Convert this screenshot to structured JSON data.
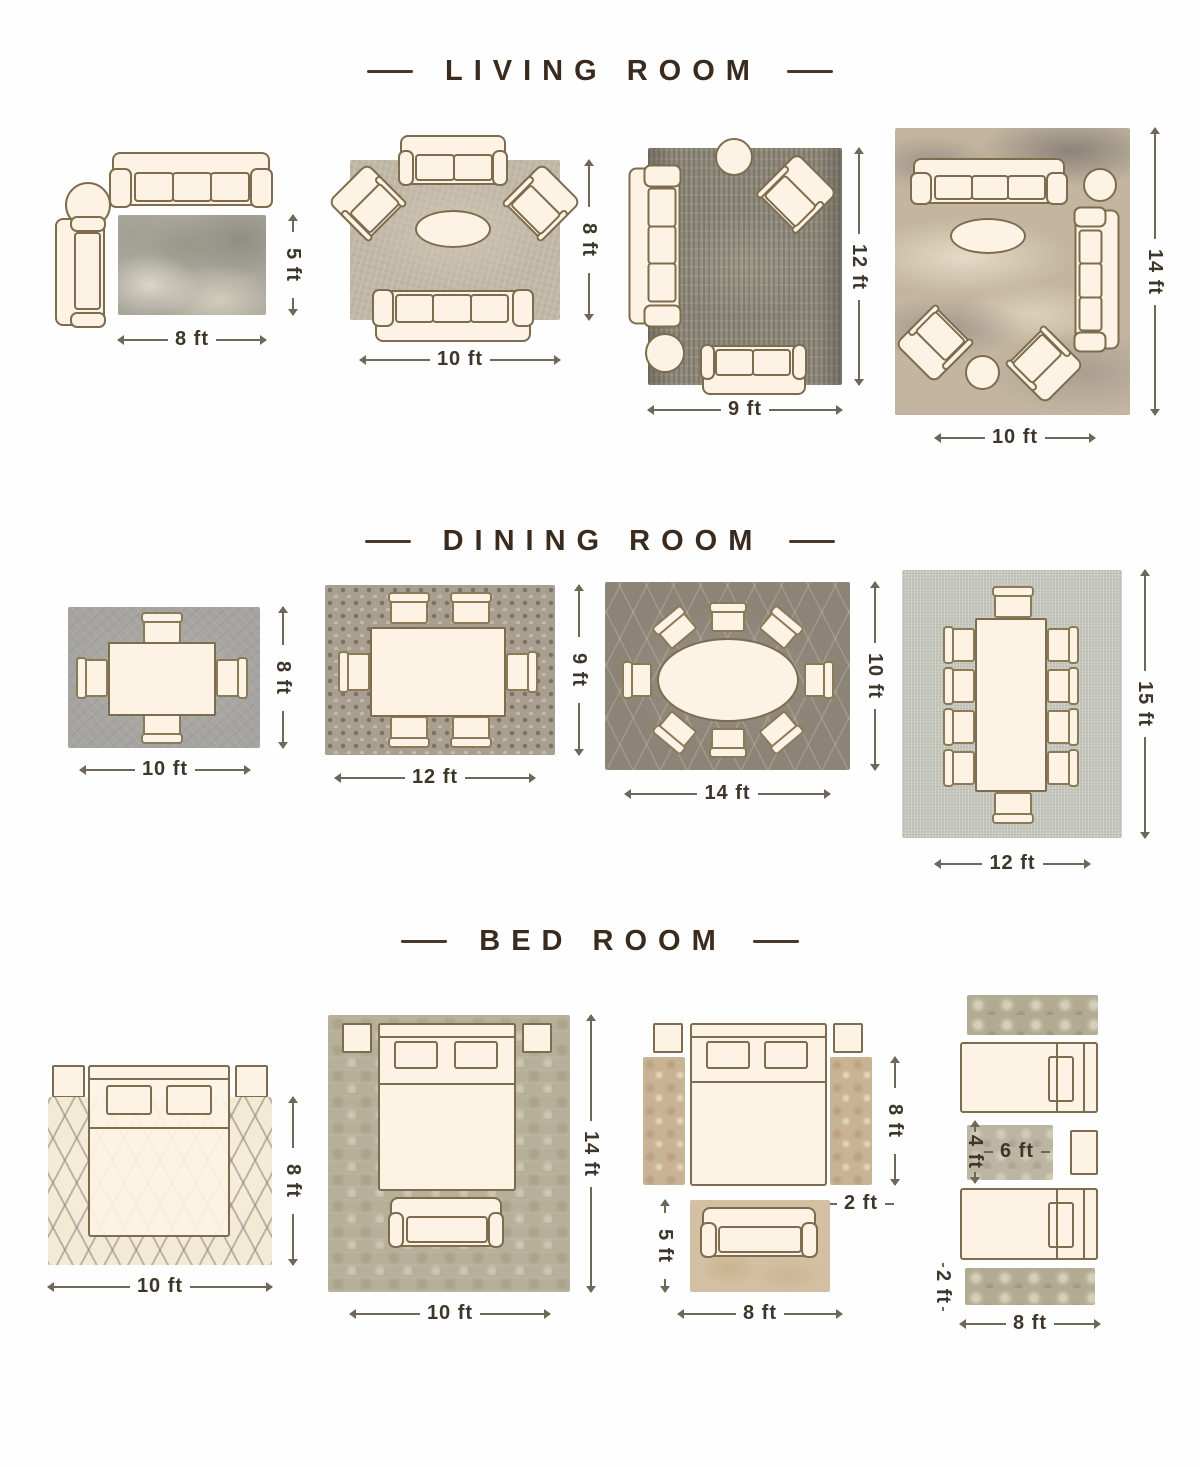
{
  "page": {
    "background": "#ffffff"
  },
  "palette": {
    "title_color": "#3b2b1e",
    "dimension_text_color": "#3e362b",
    "dimension_line_color": "#6e675a",
    "furniture_fill": "#fcf3e4",
    "furniture_outline": "#7e6c4e",
    "rug_living_1": "#a8a59a",
    "rug_living_2": "#c0b7a6",
    "rug_living_3": "#8f8a7b",
    "rug_living_4": "#c3b5a0",
    "rug_dining_1": "#a5a4a0",
    "rug_dining_2": "#a89f90",
    "rug_dining_3": "#8b8477",
    "rug_dining_4": "#c4c6bc",
    "rug_bed_1": "#f3ead5",
    "rug_bed_2": "#b6b09a",
    "rug_bed_3_runner": "#c8b394",
    "rug_bed_3_foot": "#d3c0a2",
    "rug_bed_4_runner": "#b2aa91",
    "rug_bed_4_mid": "#bcb5a2"
  },
  "sections": [
    {
      "id": "living-room",
      "title": "LIVING ROOM",
      "layouts": [
        {
          "name": "rug-8x5-two-sofas",
          "width_label": "8 ft",
          "height_label": "5 ft"
        },
        {
          "name": "rug-10x8-sofa-two-armchairs",
          "width_label": "10 ft",
          "height_label": "8 ft"
        },
        {
          "name": "rug-9x12-sofa-loveseat-armchair",
          "width_label": "9 ft",
          "height_label": "12 ft"
        },
        {
          "name": "rug-10x14-two-sofas-two-armchairs",
          "width_label": "10 ft",
          "height_label": "14 ft"
        }
      ]
    },
    {
      "id": "dining-room",
      "title": "DINING ROOM",
      "layouts": [
        {
          "name": "rug-10x8-table-4-chairs",
          "width_label": "10 ft",
          "height_label": "8 ft"
        },
        {
          "name": "rug-12x9-table-6-chairs",
          "width_label": "12 ft",
          "height_label": "9 ft"
        },
        {
          "name": "rug-14x10-oval-table-8-chairs",
          "width_label": "14 ft",
          "height_label": "10 ft"
        },
        {
          "name": "rug-12x15-table-10-chairs",
          "width_label": "12 ft",
          "height_label": "15 ft"
        }
      ]
    },
    {
      "id": "bed-room",
      "title": "BED ROOM",
      "layouts": [
        {
          "name": "rug-10x8-under-bed",
          "width_label": "10 ft",
          "height_label": "8 ft"
        },
        {
          "name": "rug-10x14-bed-and-bench",
          "width_label": "10 ft",
          "height_label": "14 ft"
        },
        {
          "name": "bed-with-side-runners-and-foot-rug",
          "runner_height_label": "8 ft",
          "runner_width_label": "2 ft",
          "foot_rug_height_label": "5 ft",
          "foot_rug_width_label": "8 ft"
        },
        {
          "name": "twin-beds-with-runners",
          "mid_rug_width_label": "6 ft",
          "mid_rug_height_label": "4 ft",
          "runner_width_label": "2 ft",
          "runner_length_label": "8 ft"
        }
      ]
    }
  ]
}
